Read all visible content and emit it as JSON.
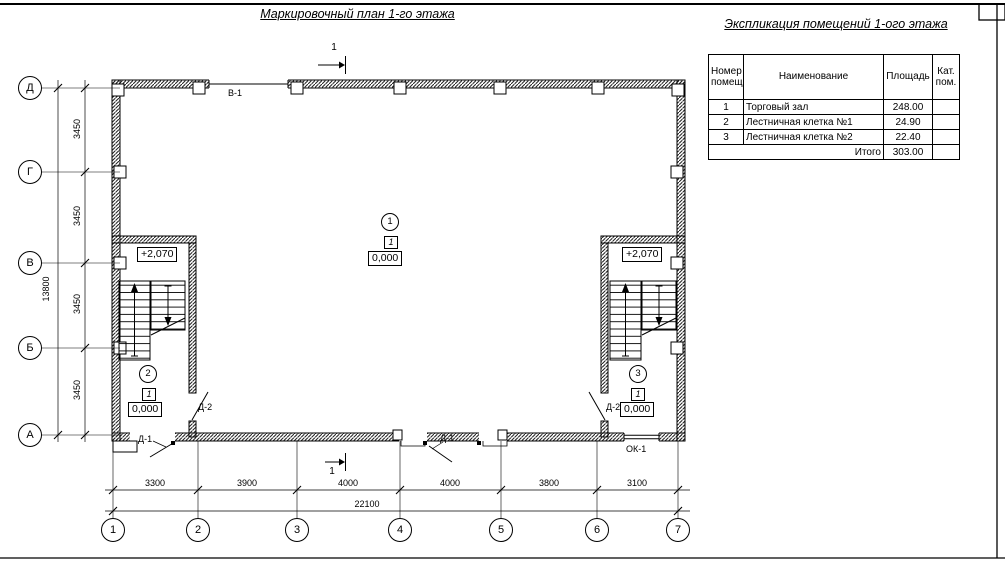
{
  "plan_title": "Маркировочный план 1-го этажа",
  "explication": {
    "title": "Экспликация помещений 1-ого этажа",
    "headers": {
      "num": "Номер помещ.",
      "name": "Наименование",
      "area": "Площадь",
      "cat": "Кат. пом."
    },
    "rows": [
      {
        "num": "1",
        "name": "Торговый зал",
        "area": "248.00",
        "cat": ""
      },
      {
        "num": "2",
        "name": "Лестничная клетка №1",
        "area": "24.90",
        "cat": ""
      },
      {
        "num": "3",
        "name": "Лестничная клетка №2",
        "area": "22.40",
        "cat": ""
      }
    ],
    "total_label": "Итого",
    "total_value": "303.00"
  },
  "axes": {
    "rows": [
      "Д",
      "Г",
      "В",
      "Б",
      "А"
    ],
    "cols": [
      "1",
      "2",
      "3",
      "4",
      "5",
      "6",
      "7"
    ]
  },
  "dimensions": {
    "left_segments": [
      "3450",
      "3450",
      "3450",
      "3450"
    ],
    "left_total": "13800",
    "bottom_segments": [
      "3300",
      "3900",
      "4000",
      "4000",
      "3800",
      "3100"
    ],
    "bottom_total": "22100"
  },
  "marks": {
    "section_number": "1",
    "window_top": "В-1",
    "window_bottom": "ОК-1",
    "door_exterior": "Д-1",
    "door_interior": "Д-2",
    "level_upper": "+2,070",
    "level_zero": "0,000",
    "category": "1",
    "rooms": [
      "1",
      "2",
      "3"
    ]
  }
}
